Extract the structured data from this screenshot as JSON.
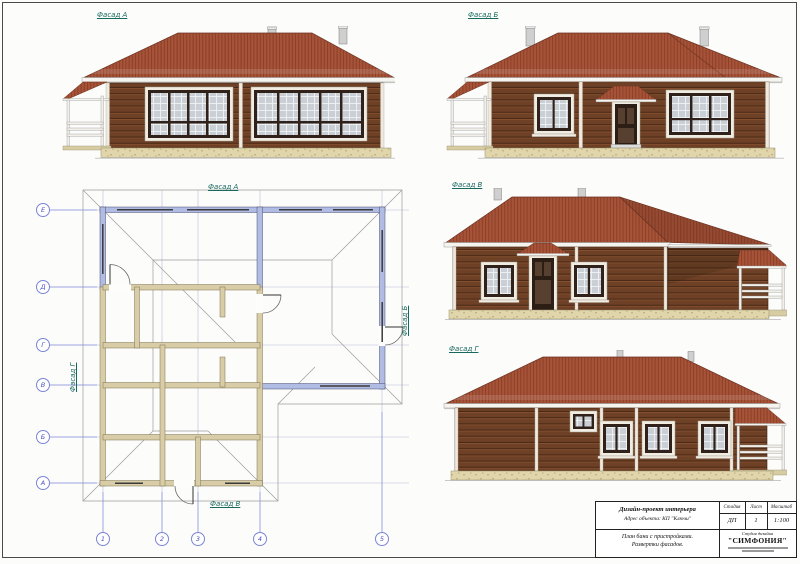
{
  "labels": {
    "facade_a": "Фасад А",
    "facade_b": "Фасад Б",
    "facade_v": "Фасад В",
    "facade_g": "Фасад Г"
  },
  "plan": {
    "top_label": "Фасад А",
    "bottom_label": "Фасад В",
    "right_label": "Фасад Б",
    "left_label": "Фасад Г",
    "axes_rows": [
      "Е",
      "Д",
      "Г",
      "В",
      "Б",
      "А"
    ],
    "axes_cols": [
      "1",
      "2",
      "3",
      "4",
      "5"
    ]
  },
  "title_block": {
    "project": "Дизайн-проект интерьера",
    "address": "Адрес объекта: КП \"Ключи\"",
    "stage_label": "Стадия",
    "sheet_label": "Лист",
    "scale_label": "Масштаб",
    "stage_value": "ДП",
    "sheet_value": "1",
    "scale_value": "1:100",
    "drawing_title_line1": "План бани с пристройками.",
    "drawing_title_line2": "Развертки фасадов.",
    "studio_label": "Студия дизайна",
    "studio_name": "\"СИМФОНИЯ\""
  },
  "colors": {
    "roof": "#a65339",
    "roof_stripe": "#8c4026",
    "wall_log": "#6e4126",
    "window_trim": "#f0ece2",
    "glass": "#c9cfd5",
    "plinth": "#e0d5ab",
    "axis_blue": "#7b84d6",
    "label_teal": "#17695e",
    "plan_wall_blue": "#b0bce4",
    "plan_wall_tan": "#d8cda6"
  }
}
